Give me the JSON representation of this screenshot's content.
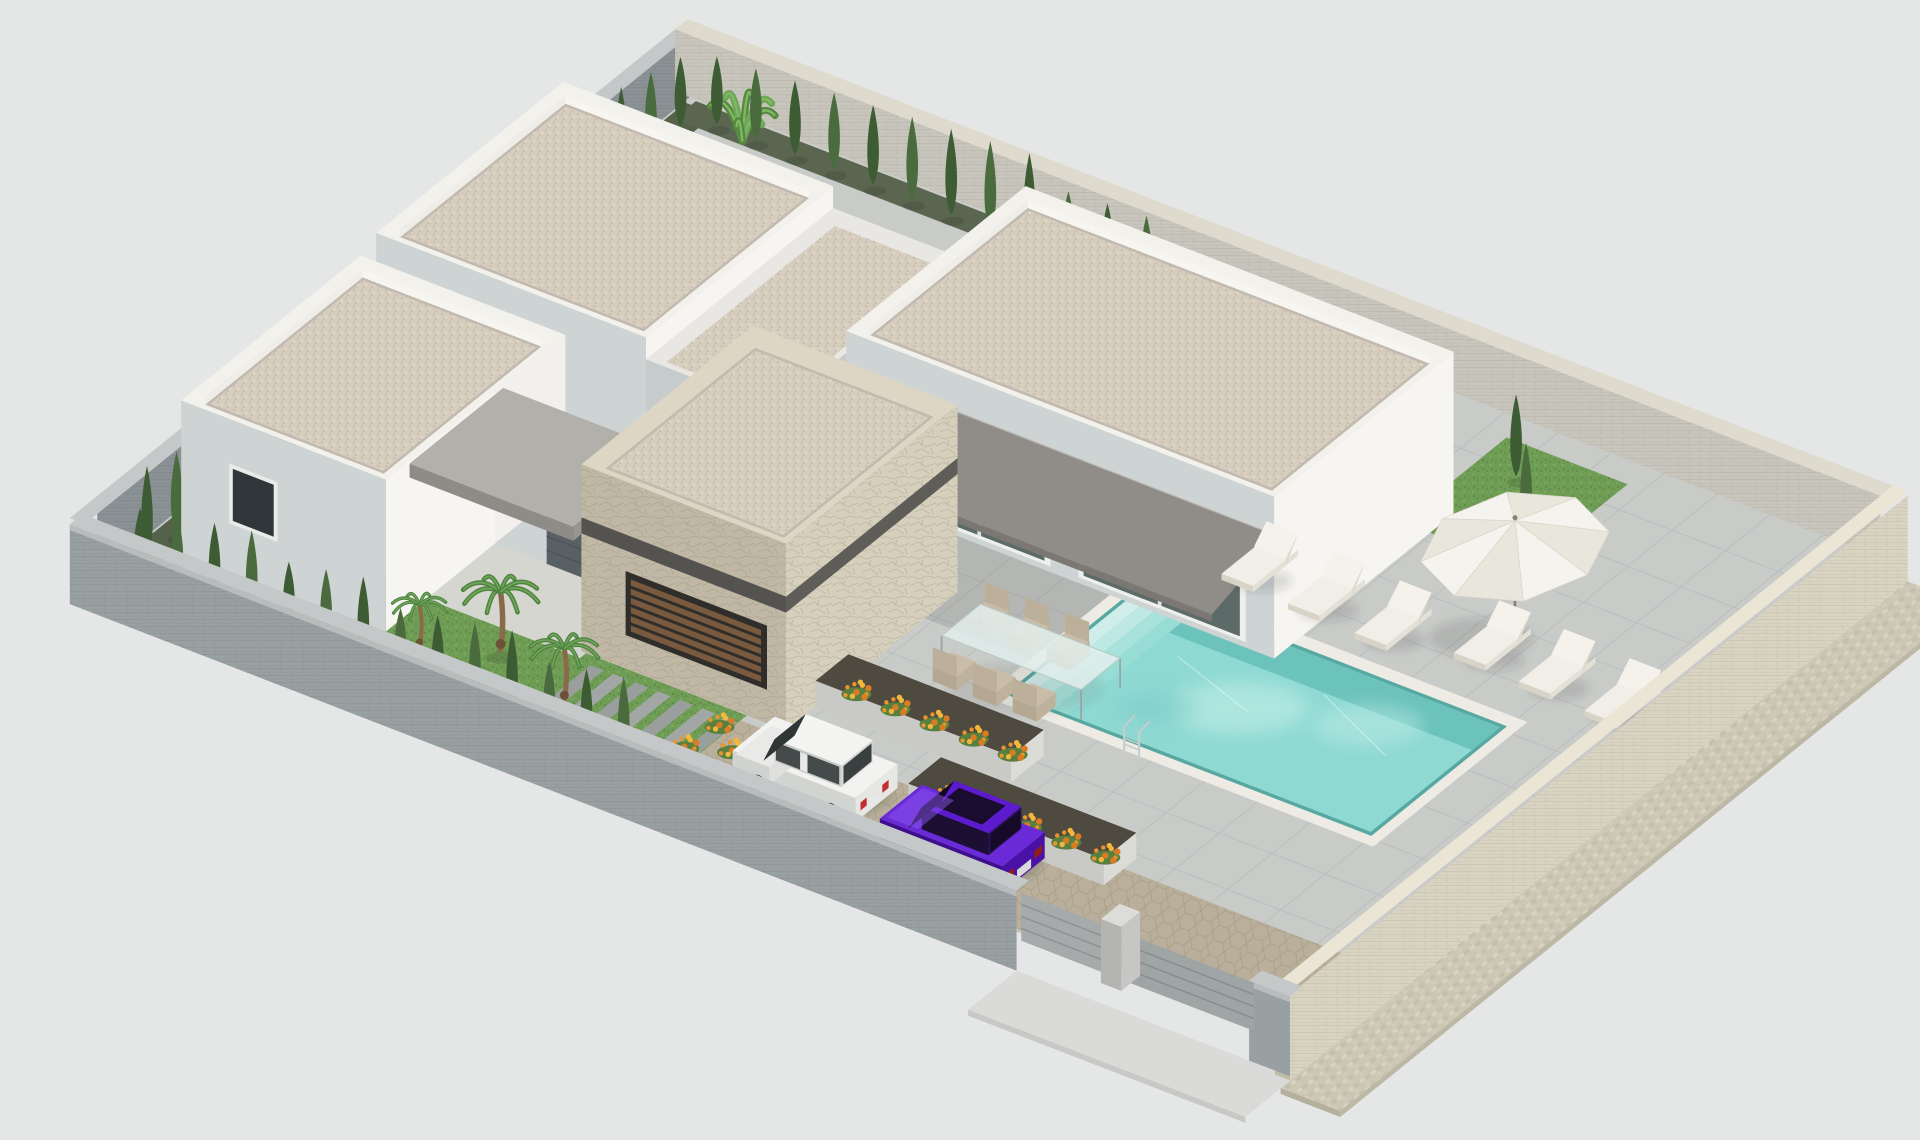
{
  "scene": {
    "type": "3d-architectural-rendering",
    "view": "axonometric aerial view",
    "subject": "Modern single-storey white villa with flat gravel roofs, stone-clad entry volume, covered terrace with awning, swimming pool, sun deck, walled garden, driveway with two parked cars",
    "objects": [
      "perimeter wall",
      "cypress hedge",
      "banana plants",
      "white villa volumes",
      "stone entry volume",
      "gray terrace awning",
      "entry door",
      "louvered wood window",
      "glass sliding doors",
      "outdoor lounge sofa",
      "glass dining set",
      "white parasol",
      "sun loungers",
      "swimming pool with steps",
      "pool ladder",
      "tiled sun deck",
      "flower planters",
      "palm trees",
      "lawn with stepping stones",
      "honeycomb paver driveway",
      "white hatchback car",
      "purple sedan car",
      "driveway gates",
      "cobblestone sidewalk"
    ]
  },
  "palette": {
    "background": "#e5e7e6",
    "deck_tile": "#c9cbc9",
    "tile_line": "#a9afae",
    "wall_gray_face": "#99a0a2",
    "wall_gray_cap": "#c4c8c8",
    "wall_nw_face": "#8b9296",
    "wall_ne_face": "#c8c6bc",
    "wall_ne_cap": "#dedacd",
    "wall_beige_face": "#d9d3c1",
    "wall_beige_cap": "#eae5d5",
    "wall_beige_end": "#c1bba9",
    "sidewalk_cobble": "#ccc6b4",
    "apron": "#dadbd8",
    "house_lit": "#f6f5f2",
    "house_mid": "#e7e8e5",
    "house_shade": "#ced3d4",
    "roof_gravel": "#d7cdbe",
    "roof_parapet": "#f3f1ec",
    "roof_inner_shade": "#c2bab0",
    "stone_lit": "#d6cfbc",
    "stone_shade": "#c0b8a5",
    "stone_top": "#ddd6c4",
    "awning": "#908d88",
    "awning_fascia": "#7b7873",
    "canopy_top": "#b2b0ab",
    "canopy_face": "#8e8c87",
    "door": "#596063",
    "glass": "#5c6a68",
    "frame": "#eef0ee",
    "louver_wood": "#7a5a3e",
    "louver_frame": "#2f2e2a",
    "grass": "#6f9d55",
    "grass_dark": "#5d8a45",
    "soil": "#55624a",
    "hedge": "#3e5c34",
    "hedge_light": "#4a6b3e",
    "palm": "#55893f",
    "palm_trunk": "#8a6a48",
    "flower_a": "#e8952f",
    "flower_b": "#f3b73d",
    "flower_c": "#d97c23",
    "driveway": "#b9af9b",
    "honey_line": "#a0957e",
    "planter": "#cdcfca",
    "planter_soil": "#4e4a40",
    "pool_coping": "#edebe4",
    "pool_water": "#8fd9d3",
    "pool_water_deep": "#6cc3bc",
    "pool_step": "#c6ede8",
    "furniture_white": "#f0eee6",
    "furniture_shade": "#d7d3c6",
    "chair_beige": "#c9bda9",
    "umbrella_a": "#f5f3ed",
    "umbrella_b": "#e9e6dc",
    "umbrella_pole": "#8a8074",
    "car_white": "#f2f2f0",
    "car_white_shade": "#d2d4d2",
    "car_purple": "#6a2ad8",
    "car_purple_dark": "#3f0e8e",
    "car_glass": "#2e3534",
    "wheel": "#2b2d2d",
    "shadow": "rgba(45,50,47,0.16)"
  }
}
